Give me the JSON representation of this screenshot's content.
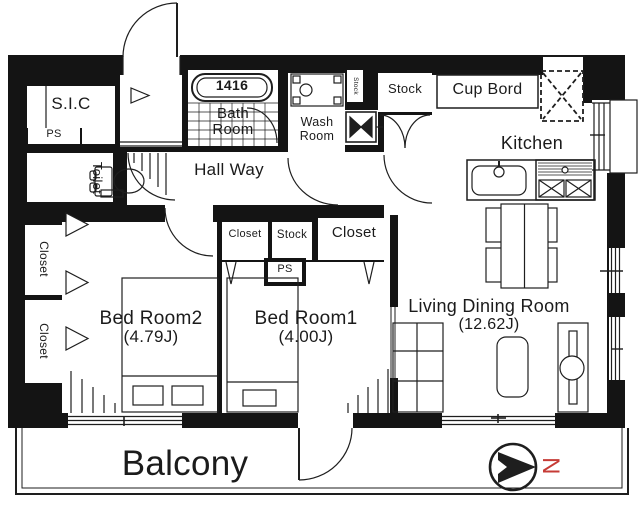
{
  "colors": {
    "wall": "#141414",
    "line": "#1e1e1e",
    "north": "#c63b36",
    "bg": "#ffffff"
  },
  "rooms": {
    "sic": {
      "label": "S.I.C"
    },
    "ps_top": {
      "label": "PS"
    },
    "toilet": {
      "label": "Toilet"
    },
    "closet_left_top": {
      "label": "Closet"
    },
    "closet_left_bottom": {
      "label": "Closet"
    },
    "bedroom2": {
      "label": "Bed Room2",
      "size": "(4.79J)"
    },
    "bedroom1": {
      "label": "Bed Room1",
      "size": "(4.00J)"
    },
    "hallway": {
      "label": "Hall Way"
    },
    "bathroom": {
      "label": "Bath Room",
      "tub_size": "1416"
    },
    "washroom": {
      "label": "Wash Room"
    },
    "stock_small": {
      "label": "Stock"
    },
    "stock_top": {
      "label": "Stock"
    },
    "cupboard": {
      "label": "Cup Bord"
    },
    "kitchen": {
      "label": "Kitchen"
    },
    "closet_mid_small": {
      "label": "Closet"
    },
    "stock_mid": {
      "label": "Stock"
    },
    "closet_mid_large": {
      "label": "Closet"
    },
    "ps_mid": {
      "label": "PS"
    },
    "living": {
      "label": "Living Dining Room",
      "size": "(12.62J)"
    },
    "balcony": {
      "label": "Balcony"
    }
  },
  "compass": {
    "north_label": "N"
  },
  "icons": {
    "compass": "north-arrow-in-circle",
    "toilet": "toilet-bowl",
    "bathtub": "bathtub-with-size",
    "vanity": "wash-basin-unit",
    "washer_pan": "washing-machine-pan",
    "kitchen_sink": "kitchen-sink-faucet",
    "stove": "gas-stove-2-burners",
    "fridge": "refrigerator-space-dashed",
    "dining": "dining-table-4-chairs",
    "beds": "single-beds-with-pillows",
    "shelf": "storage-shelf",
    "low_table": "low-table",
    "tv_board": "tv-board"
  }
}
